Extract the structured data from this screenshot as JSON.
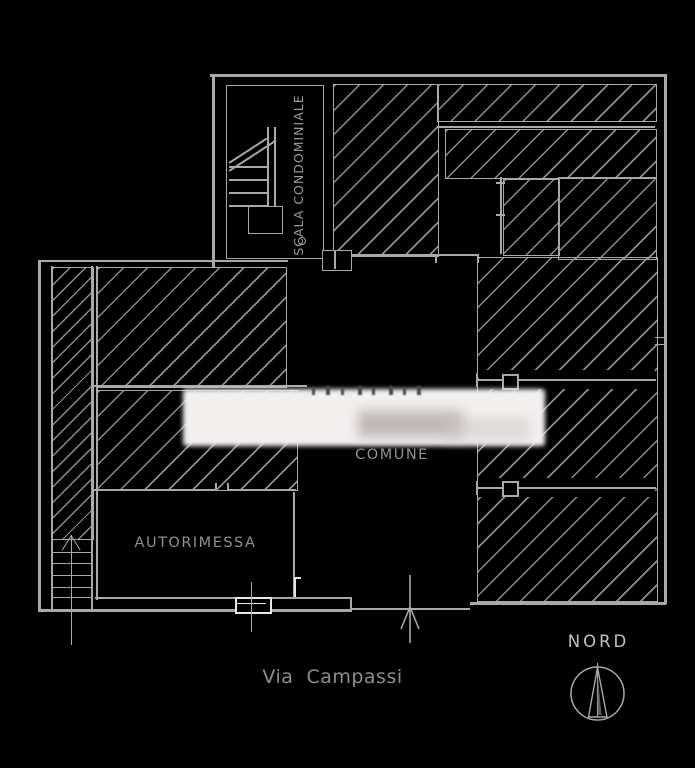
{
  "drawing": {
    "type": "architectural floor plan (ground floor)",
    "labels": {
      "stairwell": "SCALA CONDOMINIALE",
      "hall": "COMUNE",
      "garage": "AUTORIMESSA",
      "street": "Via  Campassi",
      "north": "NORD"
    },
    "colors": {
      "background": "#000000",
      "line": "#a9a9a9",
      "hatch_line": "#8d8d8d",
      "bright_line": "#e6e6e6",
      "text": "#9c9c9c",
      "redaction_fill": "#f2efef"
    },
    "icons": {
      "north_compass": "circle-with-needle-arrow",
      "entrance_arrow": "up-arrow-through-wall",
      "stair_run": "treads-with-diagonal-break-line",
      "redaction_patch": "blurred-white-rectangle"
    }
  }
}
